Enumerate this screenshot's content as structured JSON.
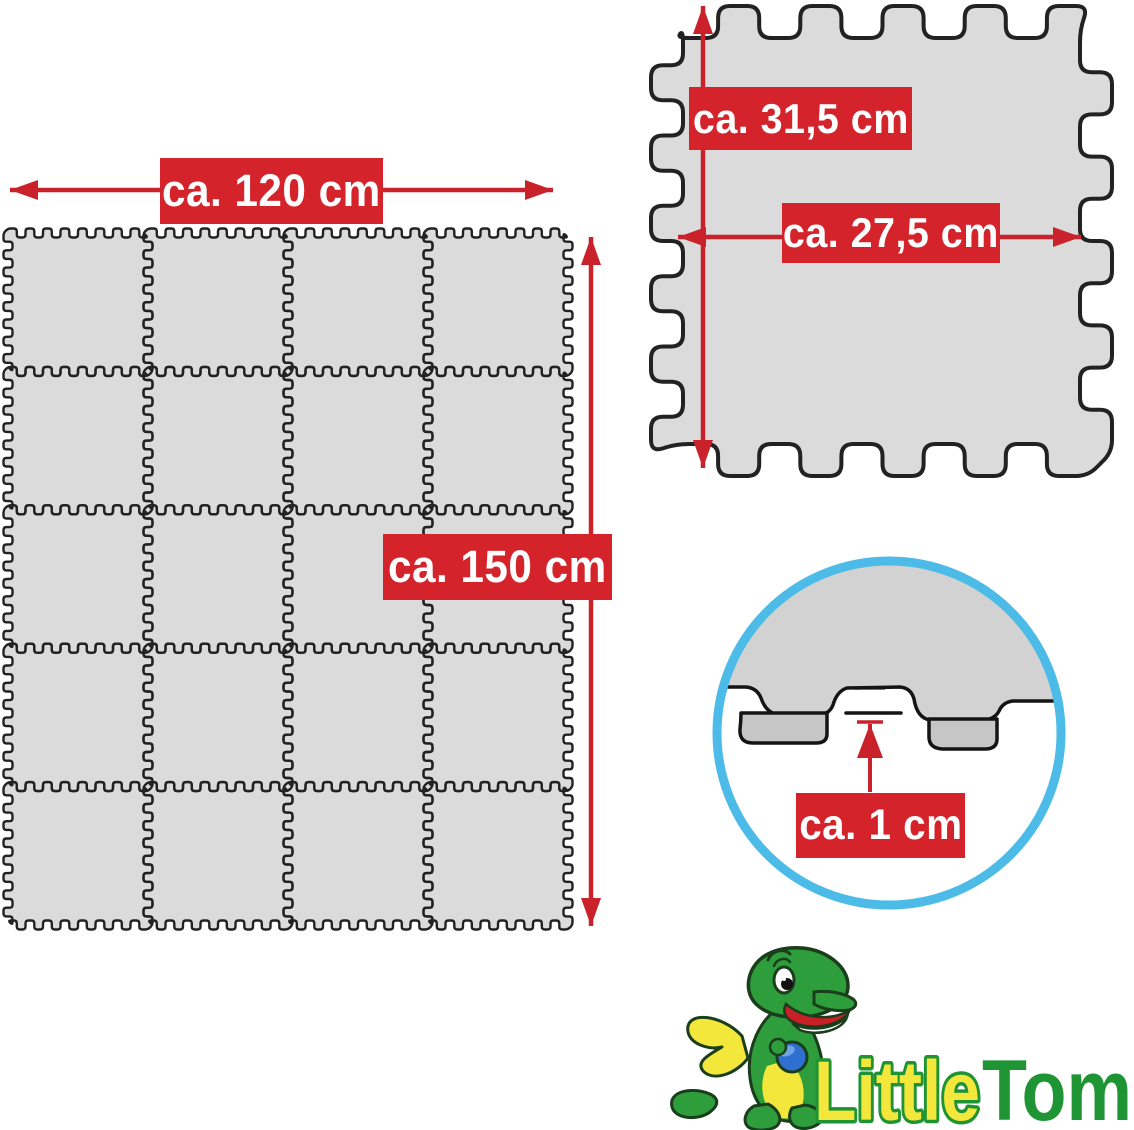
{
  "mat": {
    "rows": 5,
    "cols": 4,
    "width_label": "ca. 120 cm",
    "height_label": "ca. 150 cm"
  },
  "tile": {
    "height_label": "ca. 31,5 cm",
    "width_label": "ca. 27,5 cm"
  },
  "thickness": {
    "label": "ca. 1 cm"
  },
  "logo": {
    "first": "Little",
    "second": "Tom"
  },
  "colors": {
    "red_label": "#D4232A",
    "red_arrow": "#C9222B",
    "tile_fill": "#DBDBDB",
    "tile_outline": "#222222",
    "surface_fill": "#D2D2D2",
    "face_fill": "#C6C6C6",
    "section_outline": "#141414",
    "ring_blue": "#4DBBE7",
    "dragon_green": "#2E9E3C",
    "dragon_outline": "#1A3D1C",
    "wing_yellow": "#F2E73A",
    "ball_blue": "#2F6FD0",
    "ball_highlight": "#6FA5E8",
    "mouth_red": "#C82026",
    "logo_yellow": "#F2E73A",
    "logo_green": "#1F9434",
    "white": "#FFFFFF"
  }
}
